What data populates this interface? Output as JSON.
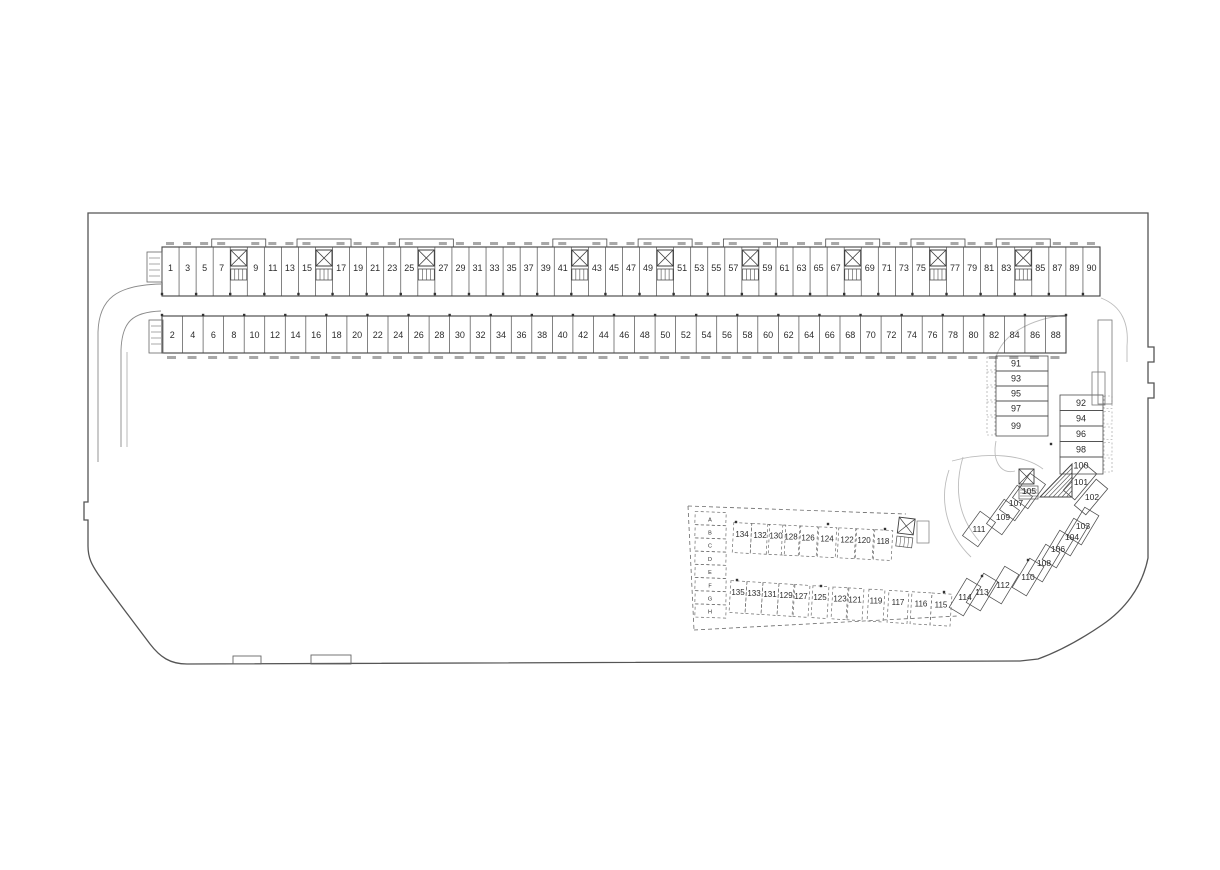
{
  "colors": {
    "background": "#ffffff",
    "line": "#4d4d4d",
    "wall": "#3f3f3f",
    "dashed_line": "#6a6a6a",
    "light_lane": "#bcbcbc",
    "text": "#2b2b2b",
    "micro_mark": "#a8a8a8"
  },
  "stalls": {
    "top": [
      "1",
      "3",
      "5",
      "7",
      "9",
      "11",
      "13",
      "15",
      "17",
      "19",
      "21",
      "23",
      "25",
      "27",
      "29",
      "31",
      "33",
      "35",
      "37",
      "39",
      "41",
      "43",
      "45",
      "47",
      "49",
      "51",
      "53",
      "55",
      "57",
      "59",
      "61",
      "63",
      "65",
      "67",
      "69",
      "71",
      "73",
      "75",
      "77",
      "79",
      "81",
      "83",
      "85",
      "87",
      "89",
      "90"
    ],
    "lifts_after_stall": [
      "7",
      "15",
      "25",
      "41",
      "49",
      "57",
      "67",
      "75",
      "83"
    ],
    "bottom": [
      "2",
      "4",
      "6",
      "8",
      "10",
      "12",
      "14",
      "16",
      "18",
      "20",
      "22",
      "24",
      "26",
      "28",
      "30",
      "32",
      "34",
      "36",
      "38",
      "40",
      "42",
      "44",
      "46",
      "48",
      "50",
      "52",
      "54",
      "56",
      "58",
      "60",
      "62",
      "64",
      "66",
      "68",
      "70",
      "72",
      "74",
      "76",
      "78",
      "80",
      "82",
      "84",
      "86",
      "88"
    ],
    "right_inner": [
      "91",
      "93",
      "95",
      "97",
      "99"
    ],
    "right_outer": [
      "92",
      "94",
      "96",
      "98",
      "100"
    ],
    "corner": [
      "101",
      "102"
    ],
    "diagonal_outer": [
      "103",
      "104",
      "106",
      "108",
      "110",
      "112",
      "113",
      "114"
    ],
    "diagonal_inner": [
      "105",
      "107",
      "109",
      "111"
    ],
    "dashed_upper": [
      "134",
      "132",
      "130",
      "128",
      "126",
      "124",
      "122",
      "120",
      "118"
    ],
    "dashed_lower": [
      "135",
      "133",
      "131",
      "129",
      "127",
      "125",
      "123",
      "121",
      "119",
      "117",
      "116",
      "115"
    ],
    "letter_cells": [
      "A",
      "B",
      "C",
      "D",
      "E",
      "F",
      "G",
      "H"
    ]
  },
  "symbols": {
    "lift_core": "crossed-box",
    "stairs": "stepped-hatch",
    "corner_stair": "hatched-triangle"
  }
}
